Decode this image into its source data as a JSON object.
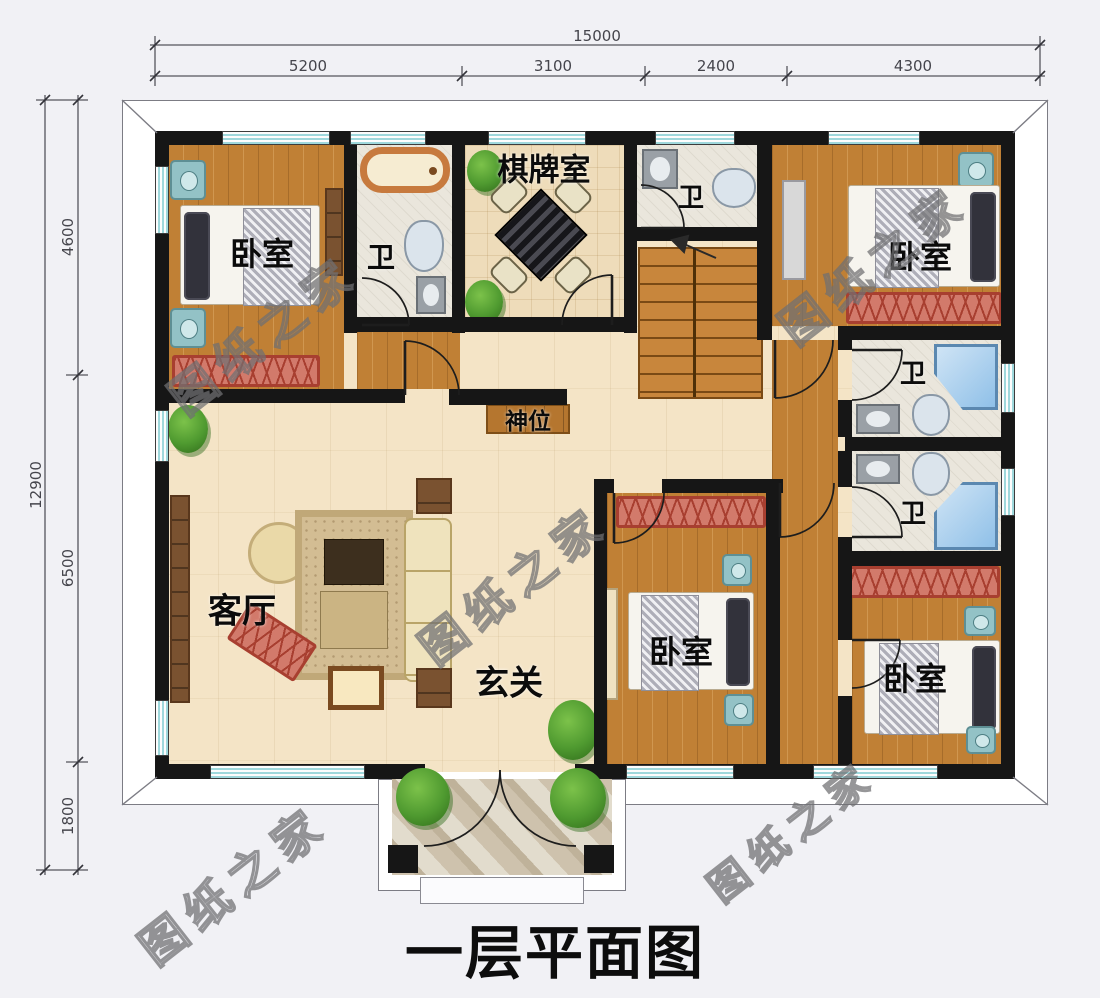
{
  "title": "一层平面图",
  "watermark": "图纸之家",
  "dimensions": {
    "top": {
      "total": "15000",
      "segments": [
        "5200",
        "3100",
        "2400",
        "4300"
      ]
    },
    "left": {
      "total": "12900",
      "segments": [
        "4600",
        "6500",
        "1800"
      ]
    }
  },
  "rooms": {
    "bedroom_tl": "卧室",
    "bath_tl": "卫",
    "chess_room": "棋牌室",
    "bath_tc": "卫",
    "bedroom_tr": "卧室",
    "bath_r1": "卫",
    "bath_r2": "卫",
    "shrine": "神位",
    "living_room": "客厅",
    "entry": "玄关",
    "bedroom_bc": "卧室",
    "bedroom_br": "卧室"
  },
  "colors": {
    "wall": "#161616",
    "wood_floor": "#c08035",
    "light_floor": "#f4e4c6",
    "window_glass": "#9fd8dc",
    "bench": "#d27a6b",
    "shower": "#8fc0e8",
    "stair": "#c8863c",
    "plant": "#4f9a30",
    "dimension_text": "#45454c",
    "title_text": "#0d0d0d"
  }
}
